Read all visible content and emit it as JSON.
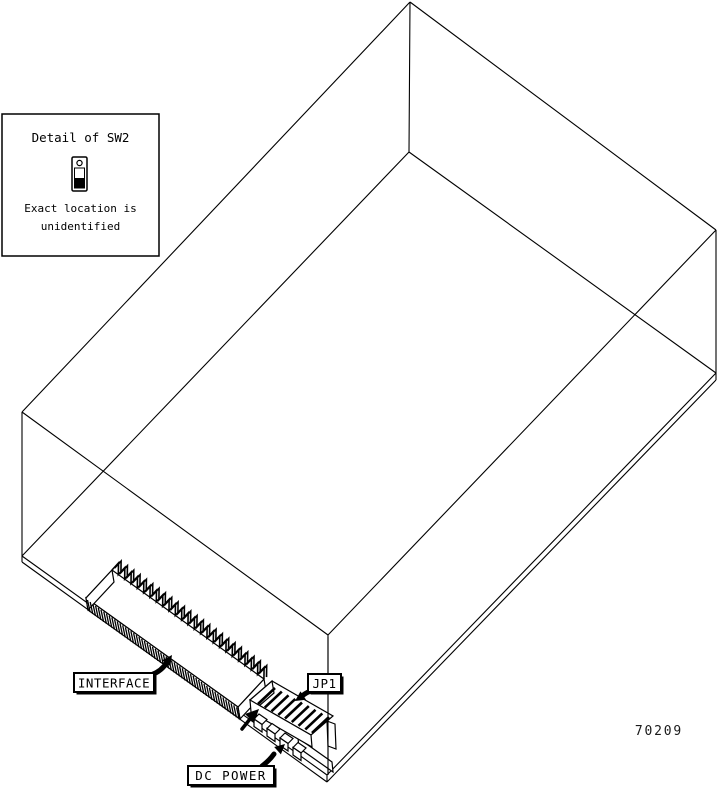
{
  "figure": {
    "part_number": "70209",
    "background_color": "#ffffff",
    "line_color": "#000000"
  },
  "detail_box": {
    "title": "Detail of SW2",
    "icon": "toggle-switch-icon",
    "note_line1": "Exact location is",
    "note_line2": "unidentified"
  },
  "callouts": {
    "interface": "INTERFACE",
    "jp1": "JP1",
    "dc_power": "DC POWER"
  }
}
